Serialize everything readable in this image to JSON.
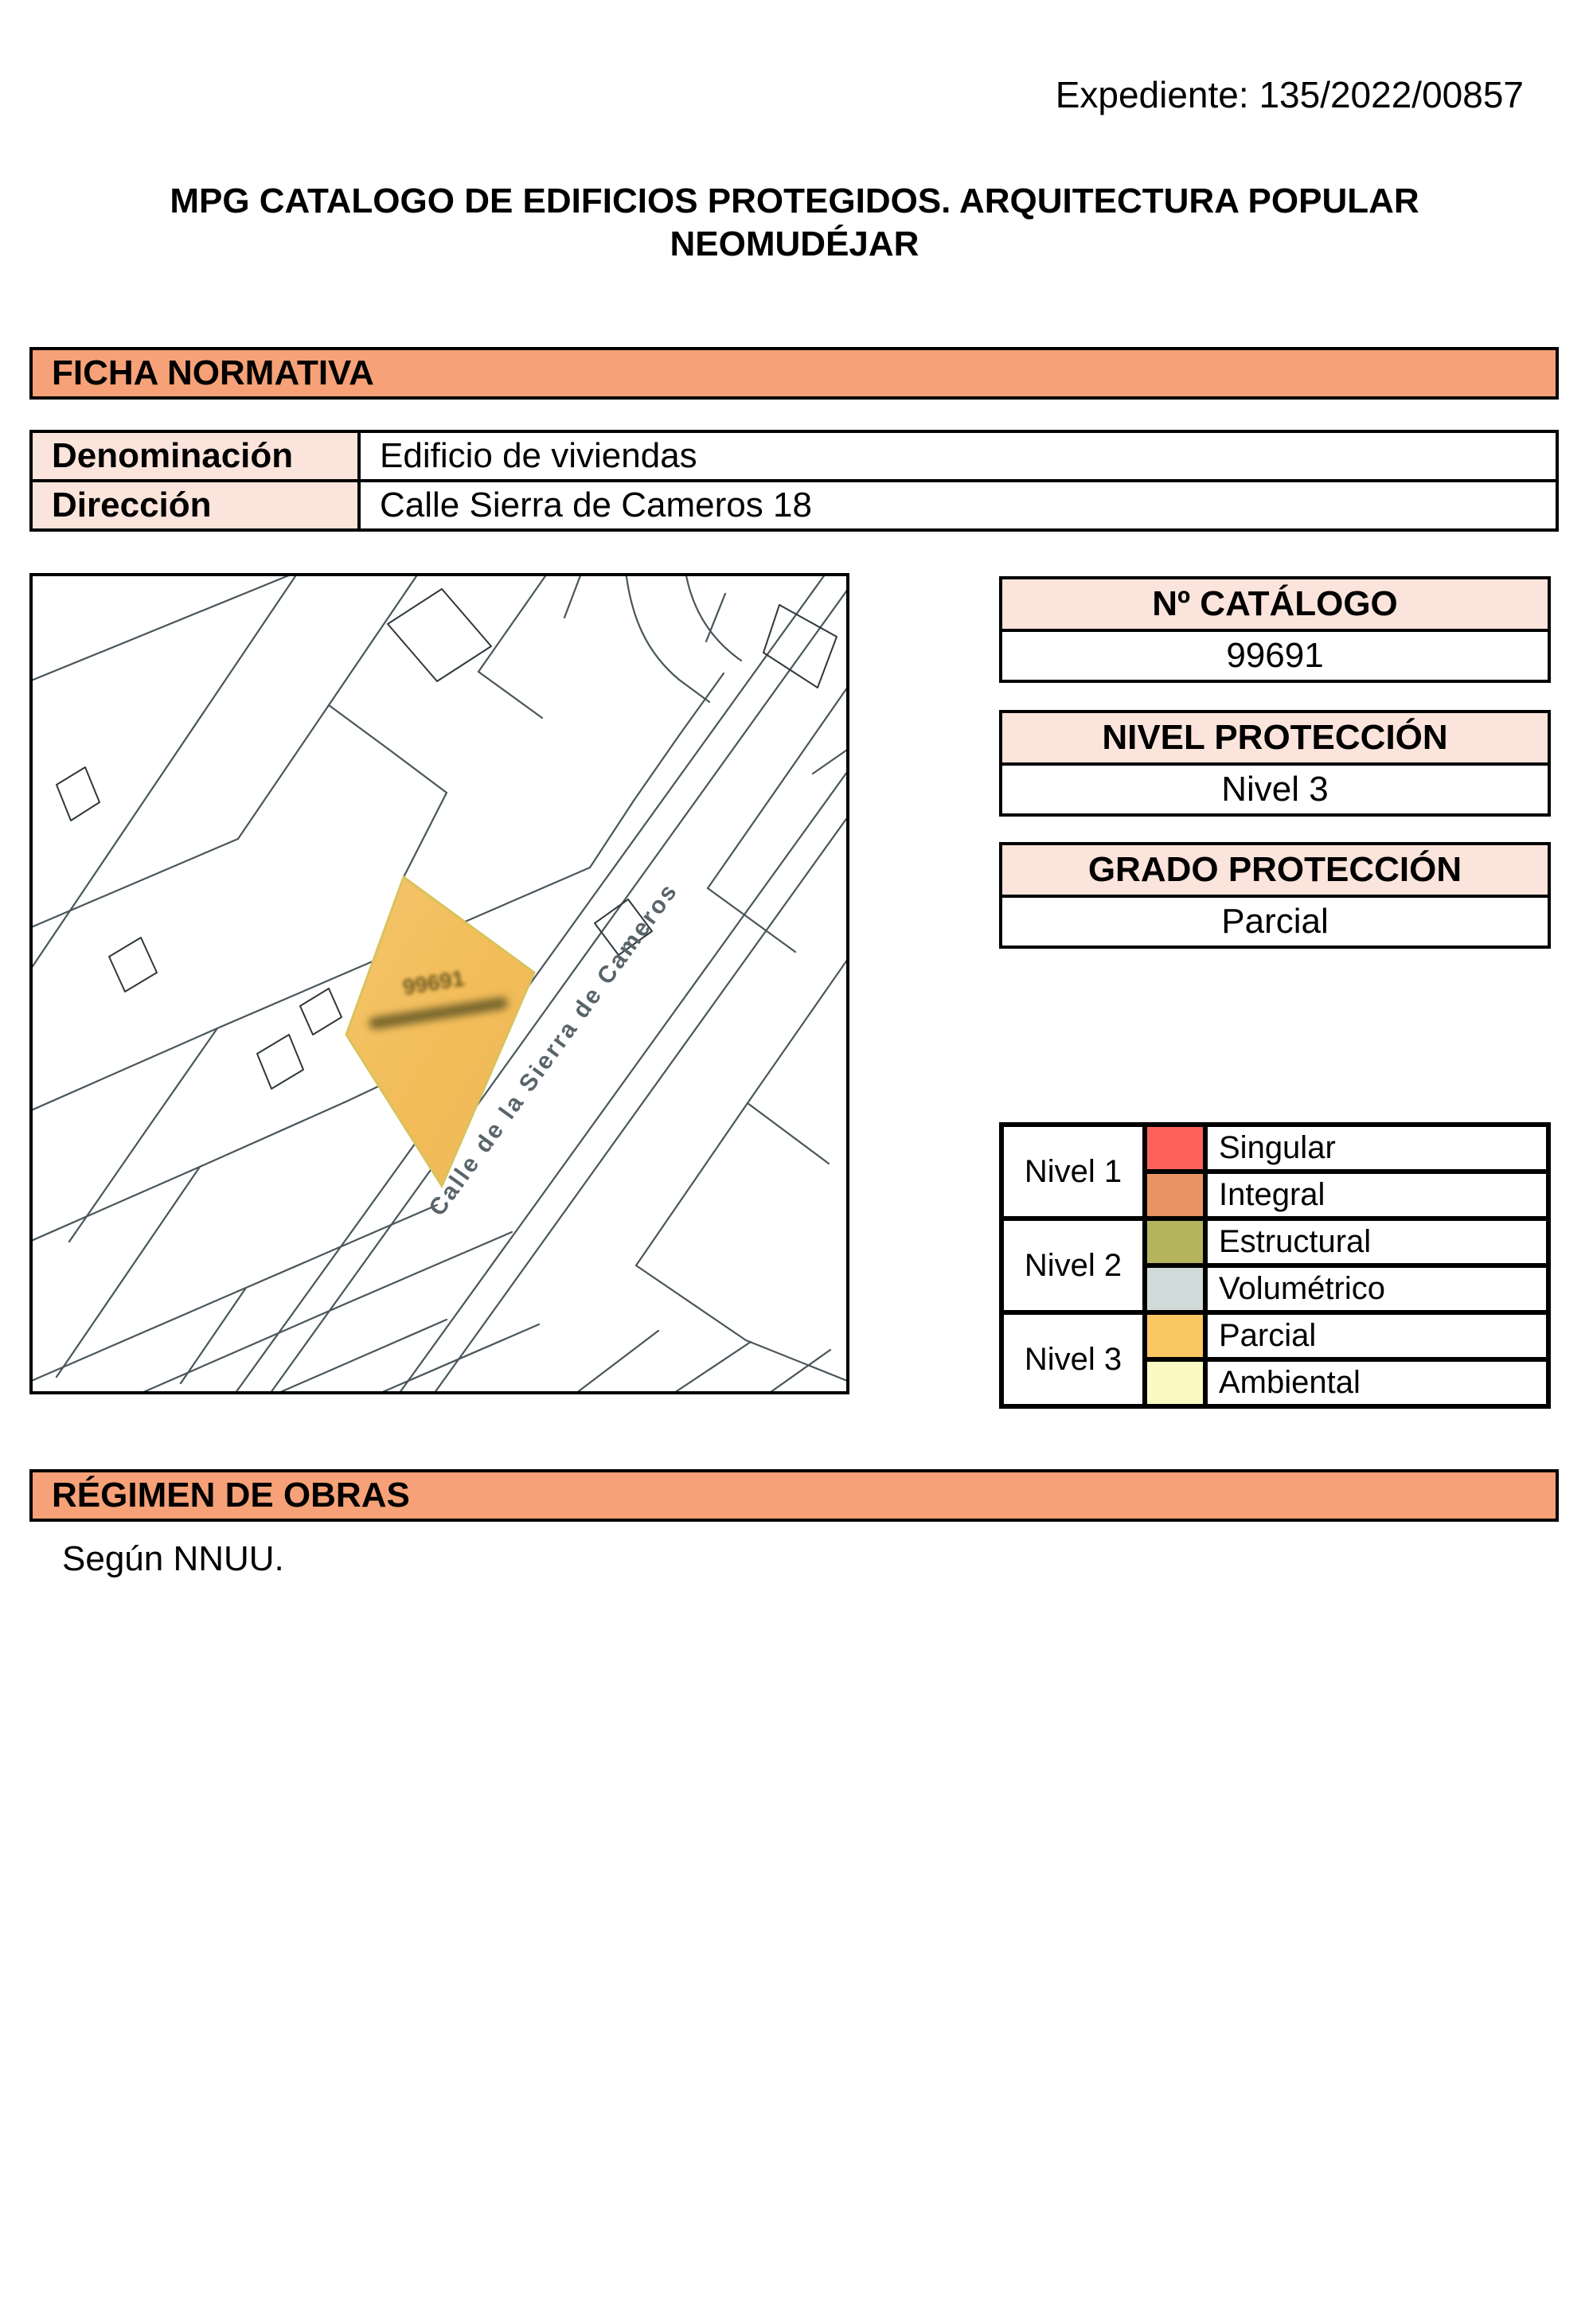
{
  "expediente": "Expediente: 135/2022/00857",
  "title": {
    "line1": "MPG CATALOGO DE EDIFICIOS PROTEGIDOS. ARQUITECTURA POPULAR",
    "line2": "NEOMUDÉJAR"
  },
  "ficha": {
    "header": "FICHA NORMATIVA"
  },
  "info": {
    "rows": [
      {
        "label": "Denominación",
        "value": "Edificio de viviendas"
      },
      {
        "label": "Dirección",
        "value": "Calle Sierra de Cameros 18"
      }
    ]
  },
  "map": {
    "street_label": "Calle de la Sierra de Cameros",
    "parcel_label": "99691",
    "parcel_color": "#F3BE5E"
  },
  "catalogo": {
    "header": "Nº CATÁLOGO",
    "value": "99691"
  },
  "nivel": {
    "header": "NIVEL PROTECCIÓN",
    "value": "Nivel 3"
  },
  "grado": {
    "header": "GRADO PROTECCIÓN",
    "value": "Parcial"
  },
  "legend": {
    "groups": [
      {
        "label": "Nivel 1",
        "entries": [
          {
            "name": "Singular",
            "color": "#FC625B"
          },
          {
            "name": "Integral",
            "color": "#E99362"
          }
        ]
      },
      {
        "label": "Nivel 2",
        "entries": [
          {
            "name": "Estructural",
            "color": "#B5B45E"
          },
          {
            "name": "Volumétrico",
            "color": "#D0DBD9"
          }
        ]
      },
      {
        "label": "Nivel 3",
        "entries": [
          {
            "name": "Parcial",
            "color": "#FAC763"
          },
          {
            "name": "Ambiental",
            "color": "#FAFAC2"
          }
        ]
      }
    ]
  },
  "regimen": {
    "header": "RÉGIMEN DE OBRAS",
    "body": "Según NNUU."
  },
  "colors": {
    "bar_bg": "#F6A177",
    "cell_bg": "#FBE4DB",
    "border": "#000000"
  }
}
